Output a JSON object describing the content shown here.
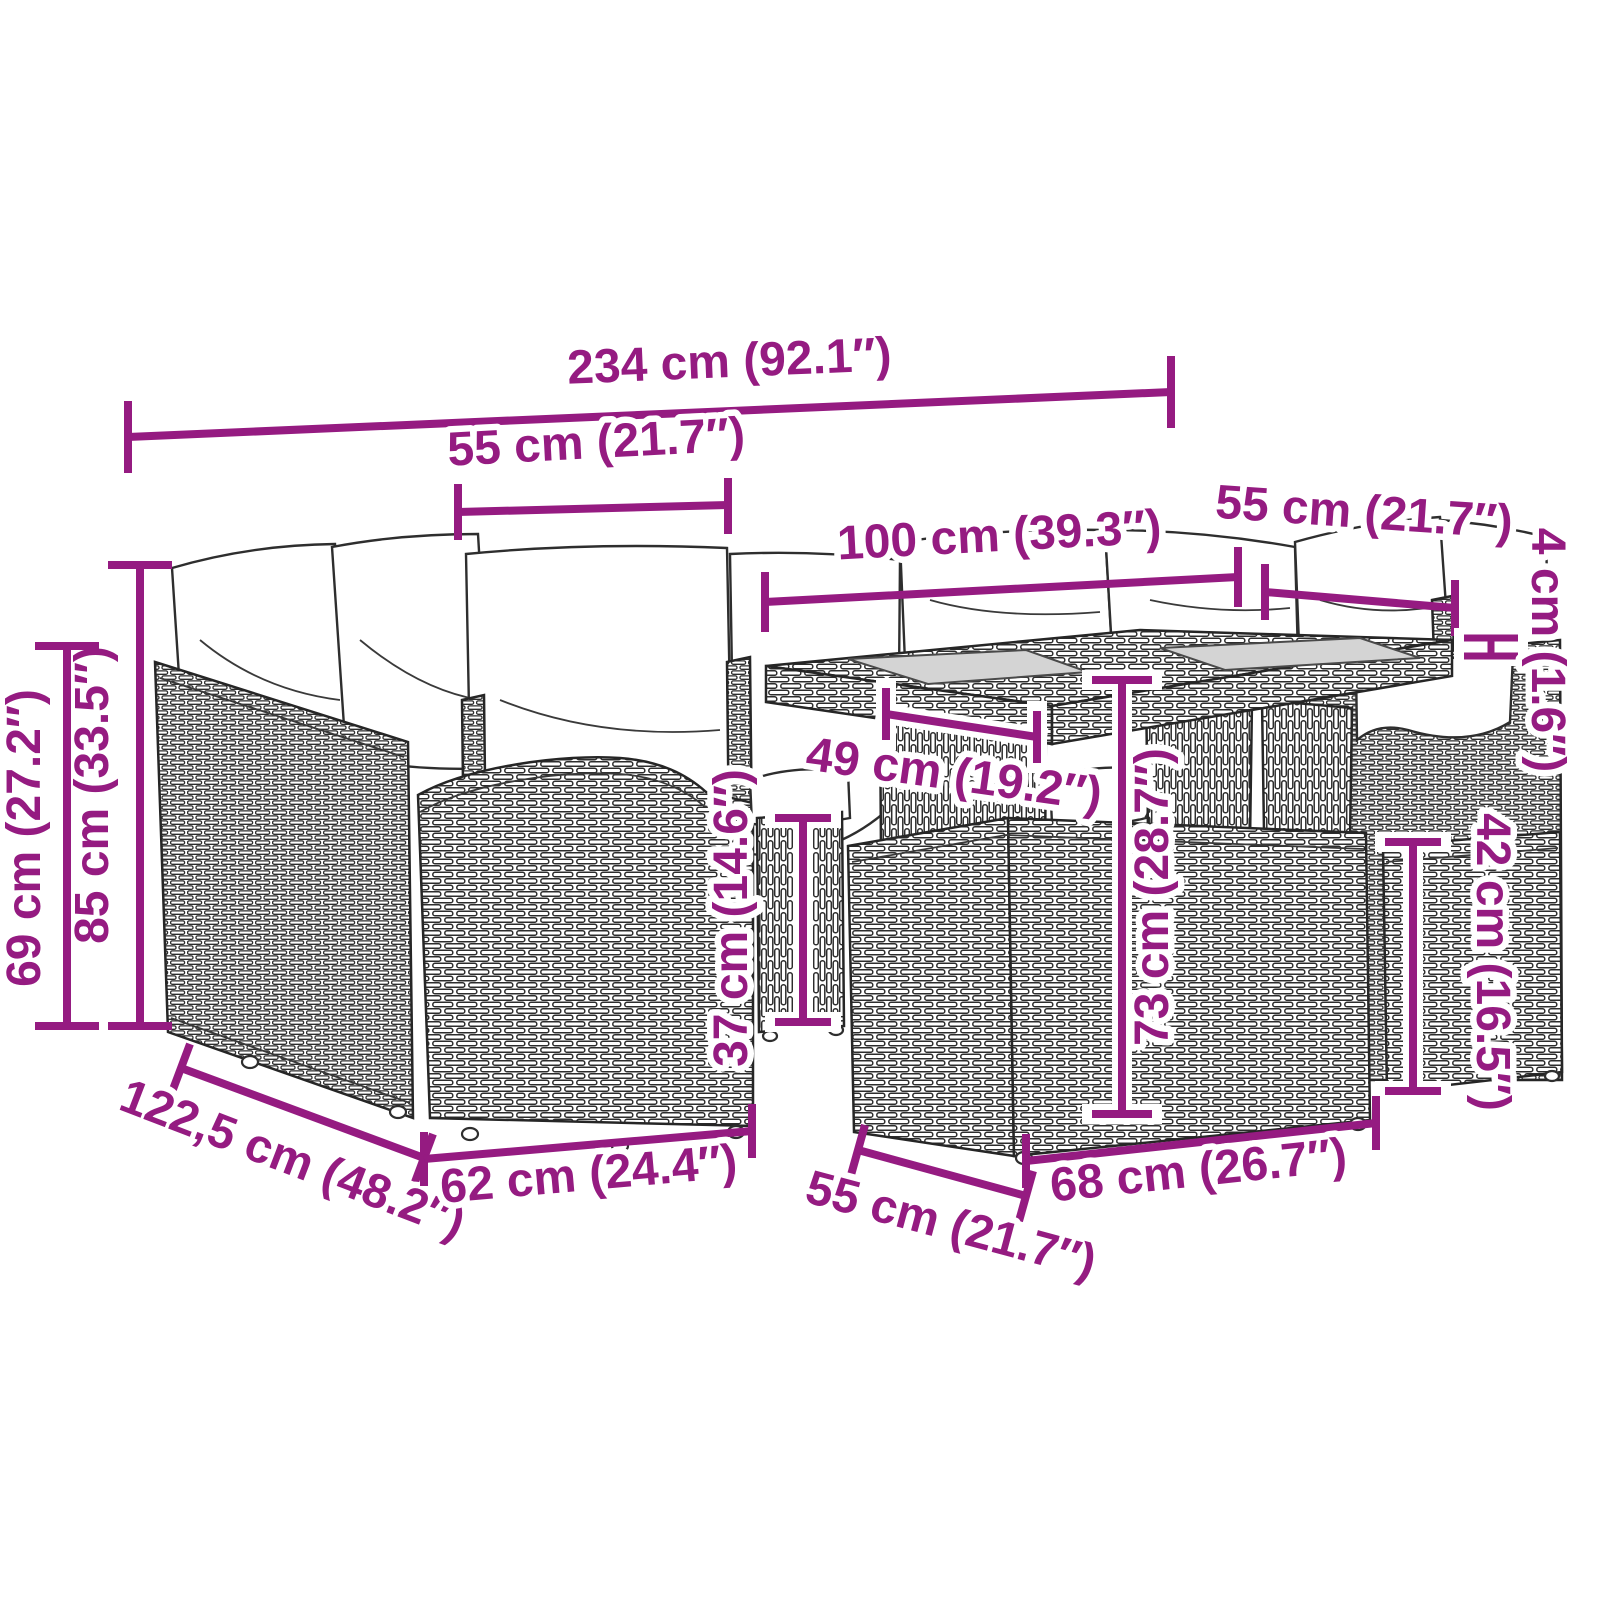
{
  "diagram": {
    "kind": "product-dimension-diagram",
    "subject": "rattan-garden-lounge-set-with-table-and-stools",
    "accent_color": "#951b81",
    "background_color": "#ffffff",
    "glass_color": "#d4d4d4",
    "dimensions": [
      {
        "id": "overall-width",
        "label": "234 cm (92.1″)"
      },
      {
        "id": "seat-width",
        "label": "55 cm (21.7″)"
      },
      {
        "id": "table-length",
        "label": "100 cm (39.3″)"
      },
      {
        "id": "table-width",
        "label": "55 cm (21.7″)"
      },
      {
        "id": "tabletop-thickness",
        "label": "4 cm (1.6″)"
      },
      {
        "id": "backrest-height",
        "label": "85 cm (33.5″)"
      },
      {
        "id": "armrest-height",
        "label": "69 cm (27.2″)"
      },
      {
        "id": "seat-depth",
        "label": "49 cm (19.2″)"
      },
      {
        "id": "table-height",
        "label": "73 cm (28.7″)"
      },
      {
        "id": "footstool-height",
        "label": "37 cm (14.6″)"
      },
      {
        "id": "stool-height",
        "label": "42 cm (16.5″)"
      },
      {
        "id": "overall-depth",
        "label": "122,5 cm (48.2″)"
      },
      {
        "id": "sofa-depth",
        "label": "62 cm (24.4″)"
      },
      {
        "id": "footstool-width",
        "label": "55 cm (21.7″)"
      },
      {
        "id": "stool-width",
        "label": "68 cm (26.7″)"
      }
    ]
  }
}
